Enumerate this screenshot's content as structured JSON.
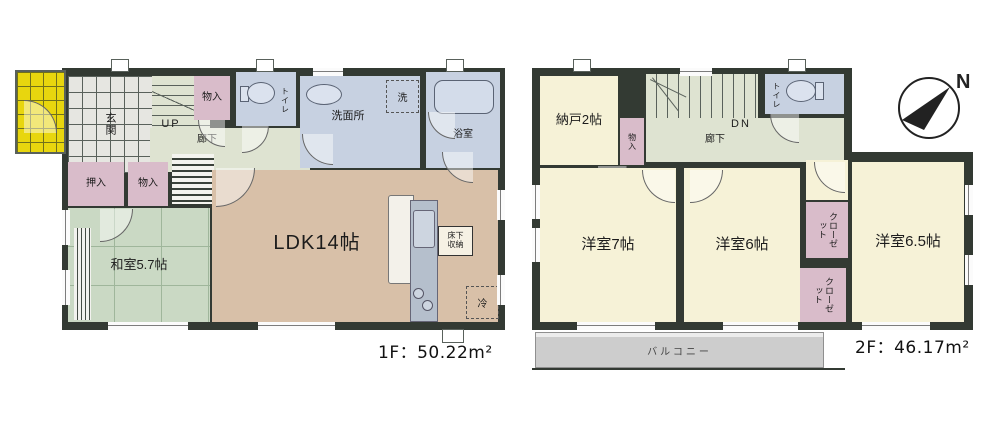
{
  "colors": {
    "wall": "#333a33",
    "ldk_floor": "#d8c0a8",
    "tatami_green": "#cad9c4",
    "corridor_sage": "#dee3d1",
    "closet_pink": "#d9bcca",
    "wet_area_blue": "#c7d1e1",
    "room_cream": "#f6f2d7",
    "porch_yellow": "#e8d60e",
    "balcony_gray": "#cdcdcd"
  },
  "floor1": {
    "area_label": "1F：50.22m²",
    "genkan": "玄関",
    "up": "UP",
    "rouka": "廊下",
    "monoire_hall": "物入",
    "toilet": "トイレ",
    "senmenjo": "洗面所",
    "washer": "洗",
    "yokushitsu": "浴室",
    "oshiire": "押入",
    "monoire": "物入",
    "washitsu": "和室5.7帖",
    "ldk": "LDK14帖",
    "yukashita1": "床下",
    "yukashita2": "収納",
    "fridge": "冷"
  },
  "floor2": {
    "area_label": "2F：46.17m²",
    "nando": "納戸2帖",
    "monoire": "物入",
    "dn": "DN",
    "rouka": "廊下",
    "toilet": "トイレ",
    "room7": "洋室7帖",
    "room6": "洋室6帖",
    "room65": "洋室6.5帖",
    "closet_upper": "クローゼット",
    "closet_lower": "クローゼット",
    "balcony": "バルコニー"
  },
  "compass": {
    "north": "N"
  }
}
